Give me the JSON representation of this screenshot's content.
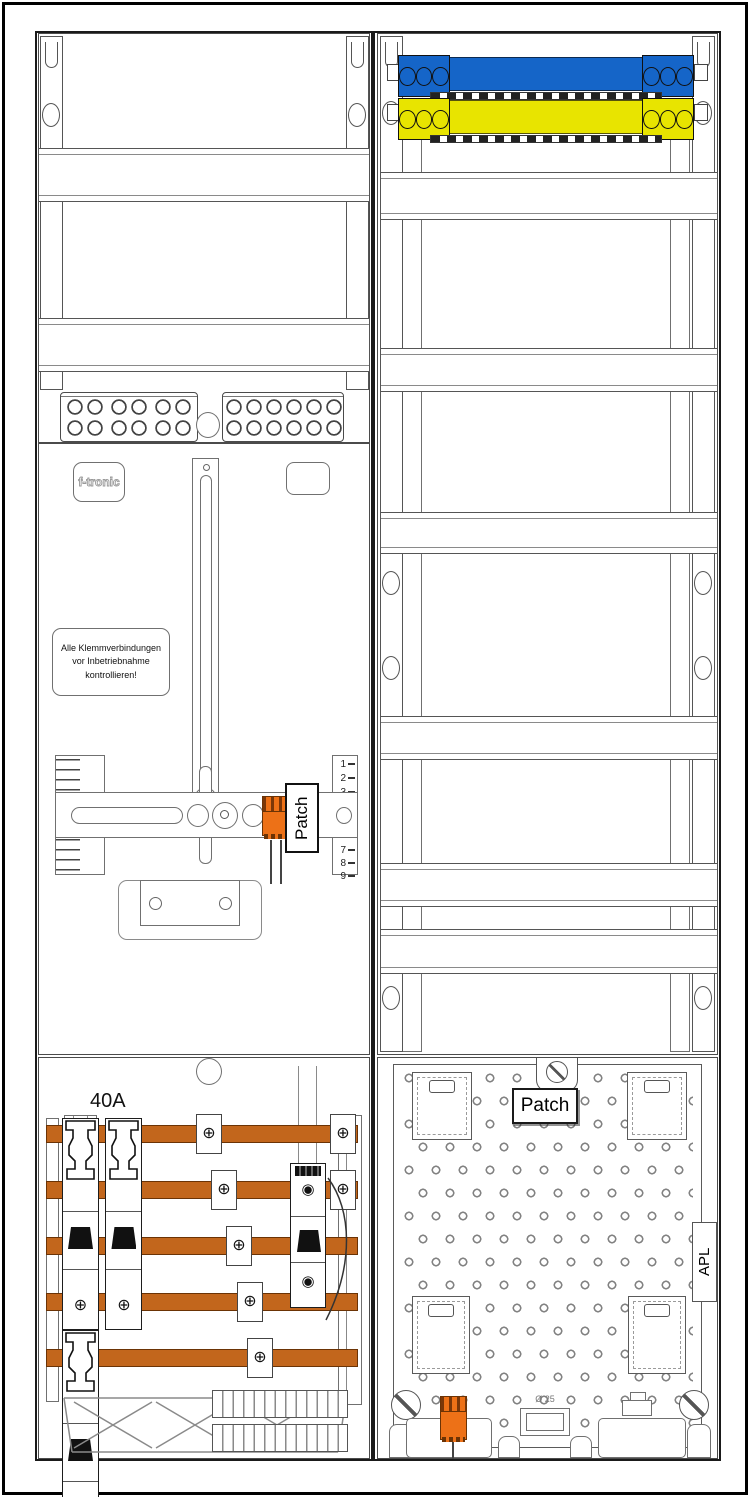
{
  "diagram": {
    "type": "electrical-meter-cabinet-technical-drawing",
    "brand": "f-tronic",
    "warning_label": {
      "line1": "Alle Klemmverbindungen",
      "line2": "vor Inbetriebnahme",
      "line3": "kontrollieren!"
    },
    "patch_connector_label": "Patch",
    "patch_plate_label": "Patch",
    "fuse_rating": "40A",
    "apl_label": "APL",
    "grommet_label": "Ø 25",
    "ruler": {
      "top": [
        "1",
        "2",
        "3"
      ],
      "bottom": [
        "7",
        "8",
        "9"
      ]
    },
    "icons": {
      "screw_cross": "⊕",
      "screw_slot": "◉"
    },
    "colors": {
      "neutral_bar": "#1565c8",
      "pe_bar": "#e8e400",
      "busbar": "#c2661c",
      "connector": "#ed7117",
      "line": "#4b4b4b"
    }
  }
}
